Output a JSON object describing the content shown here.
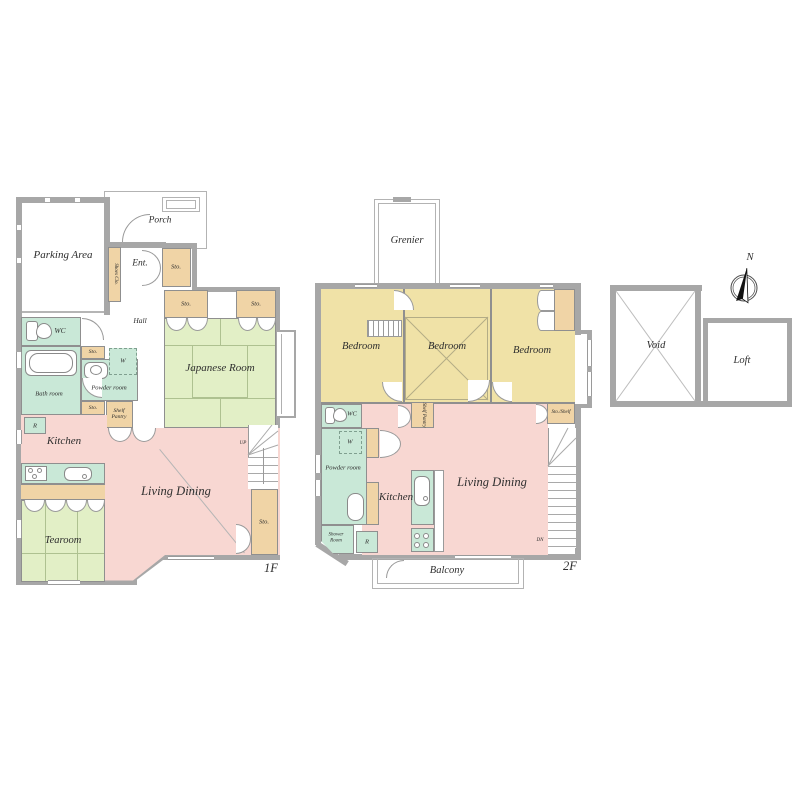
{
  "palette": {
    "room_pink": "#f8d7d2",
    "room_yellow": "#f0e2a7",
    "tatami_green": "#e2efc6",
    "wet_area_mint": "#c9e8d7",
    "storage_tan": "#f0d4a6",
    "wall_gray": "#a7a7a7"
  },
  "f1": {
    "floor_label": "1F",
    "parking": "Parking Area",
    "porch": "Porch",
    "ent": "Ent.",
    "shoes_clo": "Shoes Clo.",
    "sto": "Sto.",
    "hall": "Hall",
    "japanese_room": "Japanese Room",
    "wc": "WC",
    "bath_room": "Bath room",
    "powder_room": "Powder room",
    "w": "W",
    "shelf_pantry": "Shelf Pantry",
    "r": "R",
    "kitchen": "Kitchen",
    "living_dining": "Living Dining",
    "tearoom": "Tearoom",
    "up": "UP"
  },
  "f2": {
    "floor_label": "2F",
    "grenier": "Grenier",
    "bedroom": "Bedroom",
    "wc": "WC",
    "w": "W",
    "powder_room": "Powder room",
    "shower_room": "Shower Room",
    "r": "R",
    "kitchen": "Kitchen",
    "shelf_pantry": "Shelf Pantry",
    "living_dining": "Living Dining",
    "sto_shelf": "Sto./Shelf",
    "dn": "DN",
    "balcony": "Balcony"
  },
  "loft": {
    "void": "Void",
    "loft": "Loft",
    "north": "N"
  }
}
